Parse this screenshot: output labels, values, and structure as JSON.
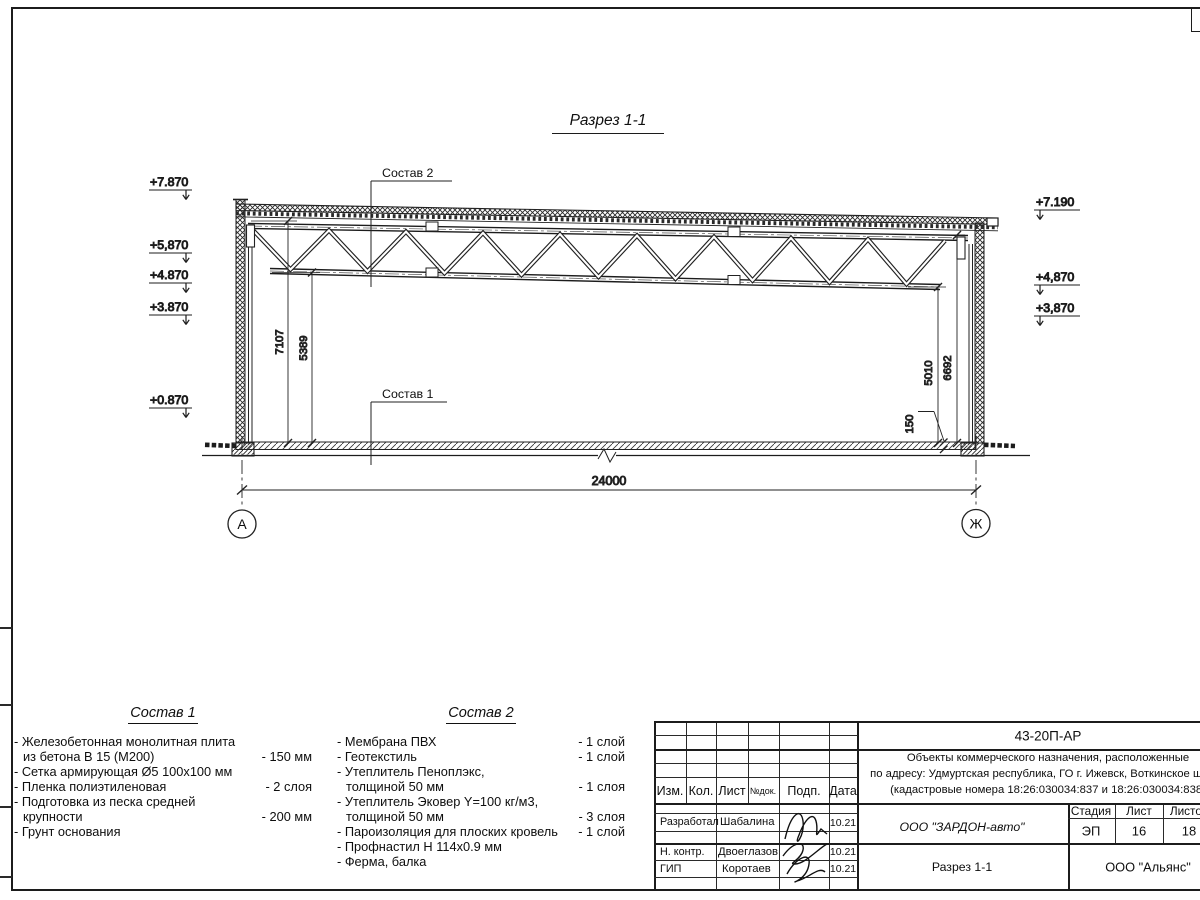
{
  "drawing": {
    "title": "Разрез 1-1",
    "labels": {
      "sostav1_ref": "Состав 1",
      "sostav2_ref": "Состав 2"
    },
    "elevations_left": [
      "+7.870",
      "+5,870",
      "+4.870",
      "+3.870",
      "+0.870"
    ],
    "elevations_right": [
      "+7.190",
      "+4,870",
      "+3,870"
    ],
    "dimensions": {
      "span": "24000",
      "height_total": "7107",
      "height_truss_bottom": "5389",
      "right_bottom_chord": "5010",
      "right_top_chord": "6692",
      "slab": "150"
    },
    "axes": {
      "left": "А",
      "right": "Ж"
    }
  },
  "sostav1": {
    "title": "Состав 1",
    "items": [
      {
        "line1": "- Железобетонная  монолитная плита",
        "line2": "из бетона В 15 (М200)",
        "value": "- 150 мм"
      },
      {
        "line1": "- Сетка армирующая Ø5 100х100 мм",
        "line2": "",
        "value": ""
      },
      {
        "line1": "- Пленка полиэтиленовая",
        "line2": "",
        "value": "-  2 слоя"
      },
      {
        "line1": "- Подготовка из песка средней",
        "line2": "крупности",
        "value": "- 200 мм"
      },
      {
        "line1": "- Грунт основания",
        "line2": "",
        "value": ""
      }
    ]
  },
  "sostav2": {
    "title": "Состав 2",
    "items": [
      {
        "line1": "- Мембрана ПВХ",
        "line2": "",
        "value": "- 1 слой"
      },
      {
        "line1": "- Геотекстиль",
        "line2": "",
        "value": "- 1 слой"
      },
      {
        "line1": "- Утеплитель Пеноплэкс,",
        "line2": "толщиной 50 мм",
        "value": "- 1 слоя"
      },
      {
        "line1": "- Утеплитель Эковер Y=100 кг/м3,",
        "line2": "толщиной 50 мм",
        "value": "- 3 слоя"
      },
      {
        "line1": "- Пароизоляция для плоских кровель",
        "line2": "",
        "value": "- 1 слой"
      },
      {
        "line1": "- Профнастил Н 114х0.9 мм",
        "line2": "",
        "value": ""
      },
      {
        "line1": "- Ферма, балка",
        "line2": "",
        "value": ""
      }
    ]
  },
  "titleblock": {
    "doc_number": "43-20П-АР",
    "project_line1": "Объекты коммерческого назначения, расположенные",
    "project_line2": "по адресу: Удмуртская республика, ГО г. Ижевск, Воткинское шоссе",
    "project_line3": "(кадастровые номера 18:26:030034:837 и 18:26:030034:838)",
    "header": {
      "izm": "Изм.",
      "kol": "Кол.",
      "list": "Лист",
      "ndok": "№док.",
      "podp": "Подп.",
      "data": "Дата"
    },
    "rows": [
      {
        "role": "Разработал",
        "name": "Шабалина",
        "date": "10.21"
      },
      {
        "role": "Н. контр.",
        "name": "Двоеглазов",
        "date": "10.21"
      },
      {
        "role": "ГИП",
        "name": "Коротаев",
        "date": "10.21"
      }
    ],
    "company": "ООО \"ЗАРДОН-авто\"",
    "sheet_title": "Разрез 1-1",
    "stage_header": {
      "stage": "Стадия",
      "sheet": "Лист",
      "sheets": "Листов"
    },
    "stage": "ЭП",
    "sheet_no": "16",
    "sheets_total": "18",
    "contractor": "ООО \"Альянс\""
  }
}
